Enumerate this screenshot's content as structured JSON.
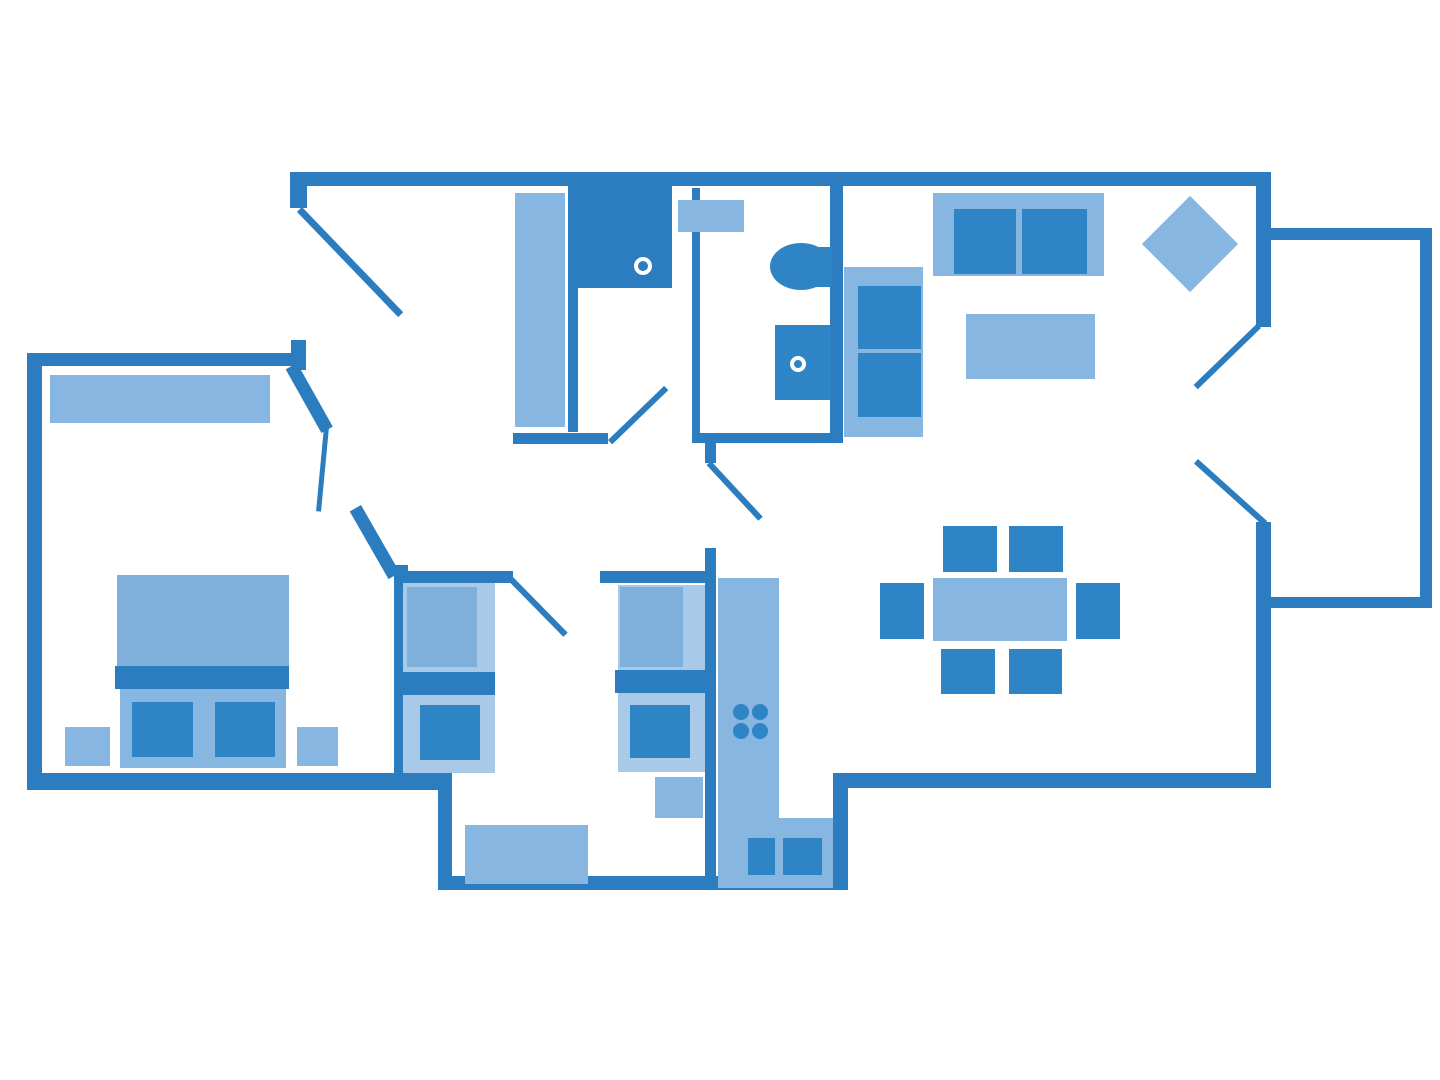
{
  "title": "apartment-floor-plan",
  "palette": {
    "wall": "#2b7dc0",
    "light": "#87b6e1",
    "lighter": "#a9c9e9",
    "duvet": "#7fb0dc",
    "medium": "#2e84c5",
    "white": "#ffffff"
  },
  "canvas": {
    "width": 1440,
    "height": 1080
  },
  "shapes": [
    {
      "n": "top-wall",
      "t": "rect",
      "x": 290,
      "y": 172,
      "w": 981,
      "h": 14,
      "c": "wall"
    },
    {
      "n": "right-wall-upper",
      "t": "rect",
      "x": 1256,
      "y": 172,
      "w": 15,
      "h": 155,
      "c": "wall"
    },
    {
      "n": "right-wall-lower",
      "t": "rect",
      "x": 1256,
      "y": 522,
      "w": 15,
      "h": 266,
      "c": "wall"
    },
    {
      "n": "living-bottom-wall",
      "t": "rect",
      "x": 833,
      "y": 773,
      "w": 438,
      "h": 15,
      "c": "wall"
    },
    {
      "n": "kitchen-right-wall",
      "t": "rect",
      "x": 833,
      "y": 773,
      "w": 15,
      "h": 117,
      "c": "wall"
    },
    {
      "n": "bumpout-bottom-wall",
      "t": "rect",
      "x": 438,
      "y": 876,
      "w": 410,
      "h": 14,
      "c": "wall"
    },
    {
      "n": "bumpout-left-wall",
      "t": "rect",
      "x": 438,
      "y": 773,
      "w": 14,
      "h": 117,
      "c": "wall"
    },
    {
      "n": "master-bottom-wall",
      "t": "rect",
      "x": 27,
      "y": 773,
      "w": 425,
      "h": 17,
      "c": "wall"
    },
    {
      "n": "master-left-wall",
      "t": "rect",
      "x": 27,
      "y": 353,
      "w": 15,
      "h": 437,
      "c": "wall"
    },
    {
      "n": "master-top-wall",
      "t": "rect",
      "x": 27,
      "y": 353,
      "w": 278,
      "h": 13,
      "c": "wall"
    },
    {
      "n": "entry-wall-stub",
      "t": "rect",
      "x": 291,
      "y": 340,
      "w": 15,
      "h": 30,
      "c": "wall"
    },
    {
      "n": "entry-corner-wall",
      "t": "rect",
      "x": 290,
      "y": 172,
      "w": 17,
      "h": 36,
      "c": "wall"
    },
    {
      "n": "closet-partition-wall",
      "t": "rect",
      "x": 568,
      "y": 186,
      "w": 10,
      "h": 246,
      "c": "wall"
    },
    {
      "n": "closet-bottom-wall",
      "t": "rect",
      "x": 513,
      "y": 433,
      "w": 95,
      "h": 11,
      "c": "wall"
    },
    {
      "n": "bathroom-left-wall",
      "t": "rect",
      "x": 692,
      "y": 188,
      "w": 8,
      "h": 250,
      "c": "wall"
    },
    {
      "n": "bathroom-bottom-wall",
      "t": "rect",
      "x": 692,
      "y": 433,
      "w": 151,
      "h": 10,
      "c": "wall"
    },
    {
      "n": "bathroom-living-wall",
      "t": "rect",
      "x": 830,
      "y": 172,
      "w": 13,
      "h": 271,
      "c": "wall"
    },
    {
      "n": "hall-door-jamb",
      "t": "rect",
      "x": 705,
      "y": 443,
      "w": 11,
      "h": 20,
      "c": "wall"
    },
    {
      "n": "kitchen-divider-wall",
      "t": "rect",
      "x": 705,
      "y": 548,
      "w": 11,
      "h": 342,
      "c": "wall"
    },
    {
      "n": "twin-top-wall-left",
      "t": "rect",
      "x": 400,
      "y": 571,
      "w": 113,
      "h": 12,
      "c": "wall"
    },
    {
      "n": "twin-top-wall-right",
      "t": "rect",
      "x": 600,
      "y": 571,
      "w": 111,
      "h": 12,
      "c": "wall"
    },
    {
      "n": "twin-left-wall",
      "t": "rect",
      "x": 394,
      "y": 565,
      "w": 14,
      "h": 210,
      "c": "wall"
    },
    {
      "n": "balcony-top-wall",
      "t": "rect",
      "x": 1262,
      "y": 228,
      "w": 170,
      "h": 12,
      "c": "wall"
    },
    {
      "n": "balcony-right-wall",
      "t": "rect",
      "x": 1420,
      "y": 228,
      "w": 12,
      "h": 380,
      "c": "wall"
    },
    {
      "n": "balcony-bottom-wall",
      "t": "rect",
      "x": 1262,
      "y": 597,
      "w": 170,
      "h": 11,
      "c": "wall"
    },
    {
      "n": "master-door-angled-wall",
      "t": "line",
      "x1": 297,
      "y1": 363,
      "x2": 333,
      "y2": 427,
      "th": 13,
      "c": "wall"
    },
    {
      "n": "hall-angled-wall",
      "t": "line",
      "x1": 361,
      "y1": 505,
      "x2": 400,
      "y2": 573,
      "th": 13,
      "c": "wall"
    },
    {
      "n": "front-door-leaf",
      "t": "line",
      "x1": 302,
      "y1": 207,
      "x2": 403,
      "y2": 312,
      "th": 7,
      "c": "wall"
    },
    {
      "n": "closet-door-leaf",
      "t": "line",
      "x1": 608,
      "y1": 440,
      "x2": 664,
      "y2": 386,
      "th": 6,
      "c": "wall"
    },
    {
      "n": "master-door-leaf",
      "t": "line",
      "x1": 329,
      "y1": 427,
      "x2": 321,
      "y2": 512,
      "th": 5,
      "c": "wall"
    },
    {
      "n": "twin-door-leaf",
      "t": "line",
      "x1": 513,
      "y1": 577,
      "x2": 568,
      "y2": 633,
      "th": 6,
      "c": "wall"
    },
    {
      "n": "hall-door-leaf",
      "t": "line",
      "x1": 711,
      "y1": 461,
      "x2": 763,
      "y2": 517,
      "th": 6,
      "c": "wall"
    },
    {
      "n": "balcony-door-leaf-upper",
      "t": "line",
      "x1": 1261,
      "y1": 328,
      "x2": 1198,
      "y2": 389,
      "th": 6,
      "c": "wall"
    },
    {
      "n": "balcony-door-leaf-lower",
      "t": "line",
      "x1": 1198,
      "y1": 459,
      "x2": 1267,
      "y2": 521,
      "th": 6,
      "c": "wall"
    },
    {
      "n": "master-wardrobe",
      "t": "rect",
      "x": 50,
      "y": 375,
      "w": 220,
      "h": 48,
      "c": "light"
    },
    {
      "n": "master-bed-duvet",
      "t": "rect",
      "x": 117,
      "y": 575,
      "w": 172,
      "h": 91,
      "c": "duvet"
    },
    {
      "n": "master-bed-band",
      "t": "rect",
      "x": 115,
      "y": 666,
      "w": 174,
      "h": 23,
      "c": "wall"
    },
    {
      "n": "master-bed-foot",
      "t": "rect",
      "x": 120,
      "y": 689,
      "w": 166,
      "h": 79,
      "c": "light"
    },
    {
      "n": "master-pillow-left",
      "t": "rect",
      "x": 132,
      "y": 702,
      "w": 61,
      "h": 55,
      "c": "medium"
    },
    {
      "n": "master-pillow-right",
      "t": "rect",
      "x": 215,
      "y": 702,
      "w": 60,
      "h": 55,
      "c": "medium"
    },
    {
      "n": "nightstand-left",
      "t": "rect",
      "x": 65,
      "y": 727,
      "w": 45,
      "h": 39,
      "c": "light"
    },
    {
      "n": "nightstand-right",
      "t": "rect",
      "x": 297,
      "y": 727,
      "w": 41,
      "h": 39,
      "c": "light"
    },
    {
      "n": "hall-wardrobe",
      "t": "rect",
      "x": 515,
      "y": 193,
      "w": 50,
      "h": 234,
      "c": "light"
    },
    {
      "n": "shower",
      "t": "rect",
      "x": 578,
      "y": 185,
      "w": 94,
      "h": 103,
      "c": "wall"
    },
    {
      "n": "shower-drain",
      "t": "ring",
      "cx": 643,
      "cy": 266,
      "r": 9,
      "bw": 4
    },
    {
      "n": "bathroom-shelf",
      "t": "rect",
      "x": 678,
      "y": 200,
      "w": 66,
      "h": 32,
      "c": "light"
    },
    {
      "n": "toilet-tank",
      "t": "rect",
      "x": 812,
      "y": 247,
      "w": 20,
      "h": 40,
      "c": "medium"
    },
    {
      "n": "toilet-bowl",
      "t": "rect",
      "x": 770,
      "y": 243,
      "w": 62,
      "h": 47,
      "c": "medium",
      "rad": "50%"
    },
    {
      "n": "bathroom-sink",
      "t": "rect",
      "x": 775,
      "y": 325,
      "w": 56,
      "h": 75,
      "c": "medium"
    },
    {
      "n": "sink-drain",
      "t": "ring",
      "cx": 798,
      "cy": 364,
      "r": 8,
      "bw": 4
    },
    {
      "n": "sofa-base",
      "t": "rect",
      "x": 933,
      "y": 193,
      "w": 171,
      "h": 83,
      "c": "light"
    },
    {
      "n": "sofa-cushion-left",
      "t": "rect",
      "x": 954,
      "y": 209,
      "w": 62,
      "h": 65,
      "c": "medium"
    },
    {
      "n": "sofa-cushion-right",
      "t": "rect",
      "x": 1022,
      "y": 209,
      "w": 65,
      "h": 65,
      "c": "medium"
    },
    {
      "n": "rug-diamond",
      "t": "rect",
      "x": 1156,
      "y": 210,
      "w": 68,
      "h": 68,
      "c": "light",
      "rot": 45
    },
    {
      "n": "coffee-table",
      "t": "rect",
      "x": 966,
      "y": 314,
      "w": 129,
      "h": 65,
      "c": "light"
    },
    {
      "n": "loveseat-base",
      "t": "rect",
      "x": 844,
      "y": 267,
      "w": 79,
      "h": 170,
      "c": "light"
    },
    {
      "n": "loveseat-cushion-top",
      "t": "rect",
      "x": 858,
      "y": 286,
      "w": 63,
      "h": 63,
      "c": "medium"
    },
    {
      "n": "loveseat-cushion-bottom",
      "t": "rect",
      "x": 858,
      "y": 353,
      "w": 63,
      "h": 64,
      "c": "medium"
    },
    {
      "n": "dining-table",
      "t": "rect",
      "x": 933,
      "y": 578,
      "w": 134,
      "h": 63,
      "c": "light"
    },
    {
      "n": "dining-chair-top-1",
      "t": "rect",
      "x": 943,
      "y": 526,
      "w": 54,
      "h": 46,
      "c": "medium"
    },
    {
      "n": "dining-chair-top-2",
      "t": "rect",
      "x": 1009,
      "y": 526,
      "w": 54,
      "h": 46,
      "c": "medium"
    },
    {
      "n": "dining-chair-left",
      "t": "rect",
      "x": 880,
      "y": 583,
      "w": 44,
      "h": 56,
      "c": "medium"
    },
    {
      "n": "dining-chair-right",
      "t": "rect",
      "x": 1076,
      "y": 583,
      "w": 44,
      "h": 56,
      "c": "medium"
    },
    {
      "n": "dining-chair-bottom-1",
      "t": "rect",
      "x": 941,
      "y": 649,
      "w": 54,
      "h": 45,
      "c": "medium"
    },
    {
      "n": "dining-chair-bottom-2",
      "t": "rect",
      "x": 1009,
      "y": 649,
      "w": 53,
      "h": 45,
      "c": "medium"
    },
    {
      "n": "kitchen-counter",
      "t": "rect",
      "x": 718,
      "y": 578,
      "w": 61,
      "h": 310,
      "c": "light"
    },
    {
      "n": "kitchen-counter-corner",
      "t": "rect",
      "x": 779,
      "y": 818,
      "w": 54,
      "h": 70,
      "c": "light"
    },
    {
      "n": "stove-burner-1",
      "t": "rect",
      "x": 733,
      "y": 704,
      "w": 16,
      "h": 16,
      "c": "medium",
      "rad": "50%"
    },
    {
      "n": "stove-burner-2",
      "t": "rect",
      "x": 752,
      "y": 704,
      "w": 16,
      "h": 16,
      "c": "medium",
      "rad": "50%"
    },
    {
      "n": "stove-burner-3",
      "t": "rect",
      "x": 733,
      "y": 723,
      "w": 16,
      "h": 16,
      "c": "medium",
      "rad": "50%"
    },
    {
      "n": "stove-burner-4",
      "t": "rect",
      "x": 752,
      "y": 723,
      "w": 16,
      "h": 16,
      "c": "medium",
      "rad": "50%"
    },
    {
      "n": "kitchen-sink-left",
      "t": "rect",
      "x": 748,
      "y": 838,
      "w": 27,
      "h": 37,
      "c": "medium"
    },
    {
      "n": "kitchen-sink-right",
      "t": "rect",
      "x": 783,
      "y": 838,
      "w": 39,
      "h": 37,
      "c": "medium"
    },
    {
      "n": "twin-bed-left-base",
      "t": "rect",
      "x": 403,
      "y": 583,
      "w": 92,
      "h": 190,
      "c": "lighter"
    },
    {
      "n": "twin-bed-left-duvet",
      "t": "rect",
      "x": 407,
      "y": 587,
      "w": 70,
      "h": 80,
      "c": "duvet"
    },
    {
      "n": "twin-bed-left-band",
      "t": "rect",
      "x": 403,
      "y": 672,
      "w": 92,
      "h": 23,
      "c": "wall"
    },
    {
      "n": "twin-bed-left-pillow",
      "t": "rect",
      "x": 420,
      "y": 705,
      "w": 60,
      "h": 55,
      "c": "medium"
    },
    {
      "n": "twin-bed-right-base",
      "t": "rect",
      "x": 618,
      "y": 585,
      "w": 87,
      "h": 187,
      "c": "lighter"
    },
    {
      "n": "twin-bed-right-duvet",
      "t": "rect",
      "x": 620,
      "y": 587,
      "w": 63,
      "h": 80,
      "c": "duvet"
    },
    {
      "n": "twin-bed-right-band",
      "t": "rect",
      "x": 615,
      "y": 670,
      "w": 90,
      "h": 23,
      "c": "wall"
    },
    {
      "n": "twin-bed-right-pillow",
      "t": "rect",
      "x": 630,
      "y": 705,
      "w": 60,
      "h": 53,
      "c": "medium"
    },
    {
      "n": "twin-side-table",
      "t": "rect",
      "x": 655,
      "y": 777,
      "w": 48,
      "h": 41,
      "c": "light"
    },
    {
      "n": "twin-desk",
      "t": "rect",
      "x": 465,
      "y": 825,
      "w": 123,
      "h": 59,
      "c": "light"
    }
  ]
}
